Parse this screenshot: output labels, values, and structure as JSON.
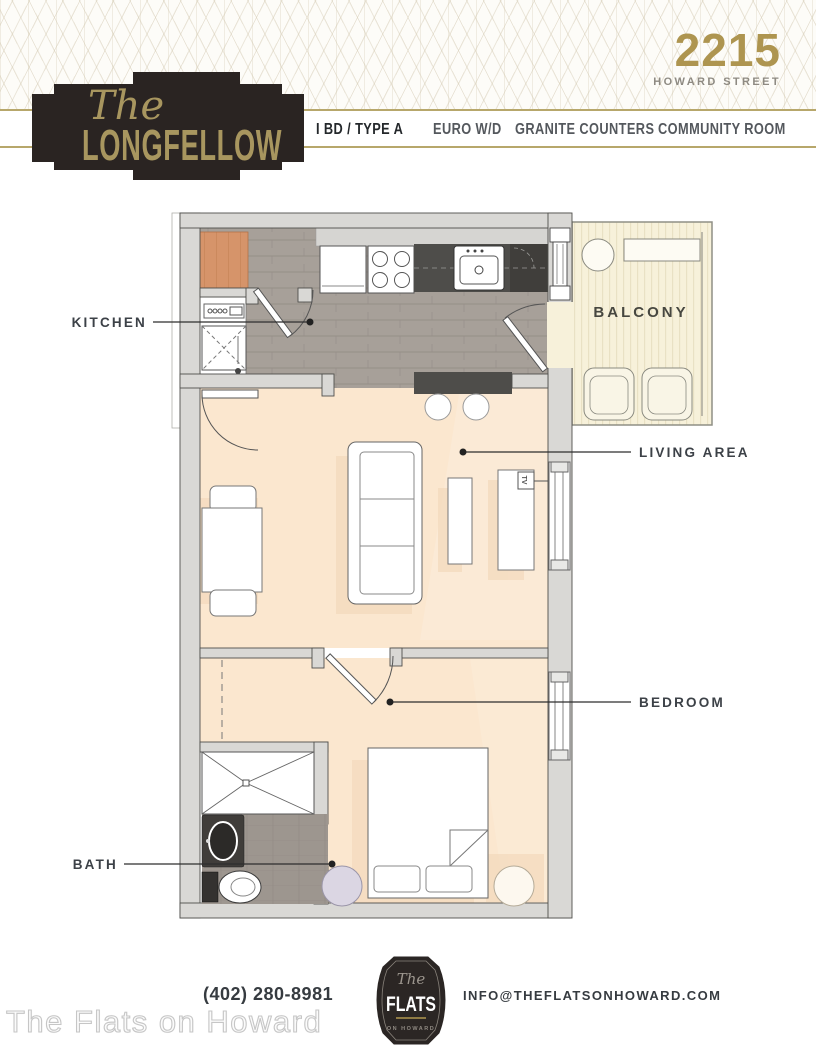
{
  "header": {
    "building_number": "2215",
    "street": "HOWARD STREET",
    "plaque": {
      "the": "The",
      "name": "LONGFELLOW"
    },
    "features": [
      {
        "label": "I BD / TYPE A"
      },
      {
        "label": "EURO W/D"
      },
      {
        "label": "GRANITE COUNTERS"
      },
      {
        "label": "COMMUNITY ROOM"
      }
    ]
  },
  "floorplan": {
    "rooms": [
      {
        "name": "KITCHEN"
      },
      {
        "name": "BALCONY"
      },
      {
        "name": "LIVING AREA"
      },
      {
        "name": "BEDROOM"
      },
      {
        "name": "BATH"
      }
    ],
    "tv_label": "TV"
  },
  "footer": {
    "phone": "(402) 280-8981",
    "email": "INFO@THEFLATSONHOWARD.COM",
    "logo": {
      "the": "The",
      "name": "FLATS",
      "sub": "ON HOWARD"
    },
    "watermark": "The Flats on Howard"
  },
  "colors": {
    "gold": "#b3a068",
    "gold_text": "#a8965f",
    "plaque": "#2a2422",
    "label_text": "#3c4147",
    "floor_cream": "#fbe7cf",
    "floor_tile": "#a7a099",
    "counter_dark": "#4e4d4a",
    "balcony_floor": "#f7f1da"
  }
}
